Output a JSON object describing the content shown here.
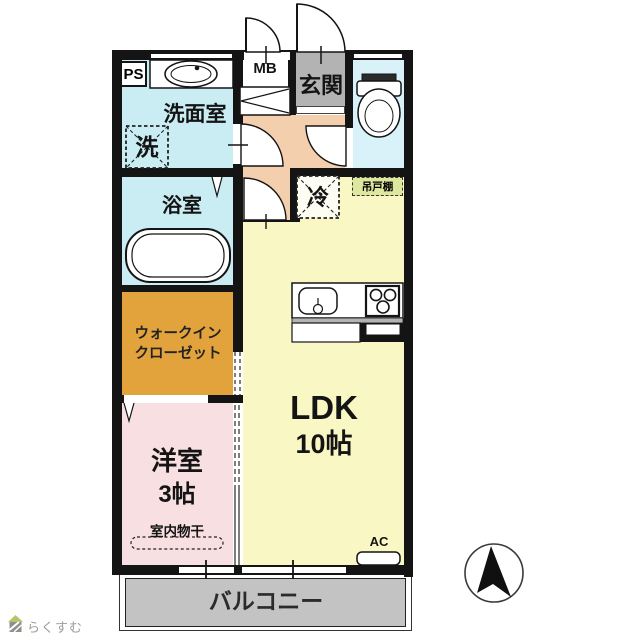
{
  "floorplan": {
    "rooms": {
      "ps": {
        "label": "PS"
      },
      "mb": {
        "label": "MB"
      },
      "entrance": {
        "label": "玄関"
      },
      "washroom": {
        "label": "洗面室"
      },
      "washer_space": {
        "label": "洗"
      },
      "bathroom": {
        "label": "浴室"
      },
      "fridge_space": {
        "label": "冷"
      },
      "hanging_cupboard": {
        "label": "吊戸棚"
      },
      "walk_in_closet": {
        "label_line1": "ウォークイン",
        "label_line2": "クローゼット"
      },
      "ldk": {
        "label": "LDK",
        "size": "10帖"
      },
      "western_room": {
        "label": "洋室",
        "size": "3帖"
      },
      "indoor_drying": {
        "label": "室内物干"
      },
      "balcony": {
        "label": "バルコニー"
      },
      "ac_unit": {
        "label": "AC"
      }
    },
    "colors": {
      "wall": "#141414",
      "water_rooms": "#c9edf3",
      "toilet_room": "#d9f1f8",
      "hall": "#f4cfae",
      "ldk": "#f9f7c3",
      "walk_in_closet": "#e2a23c",
      "western_room": "#f8dfe1",
      "entrance": "#b3b3b3",
      "balcony": "#c3c3c3",
      "hanging_cupboard": "#dde89e"
    },
    "branding": {
      "logo_text": "らくすむ"
    }
  }
}
